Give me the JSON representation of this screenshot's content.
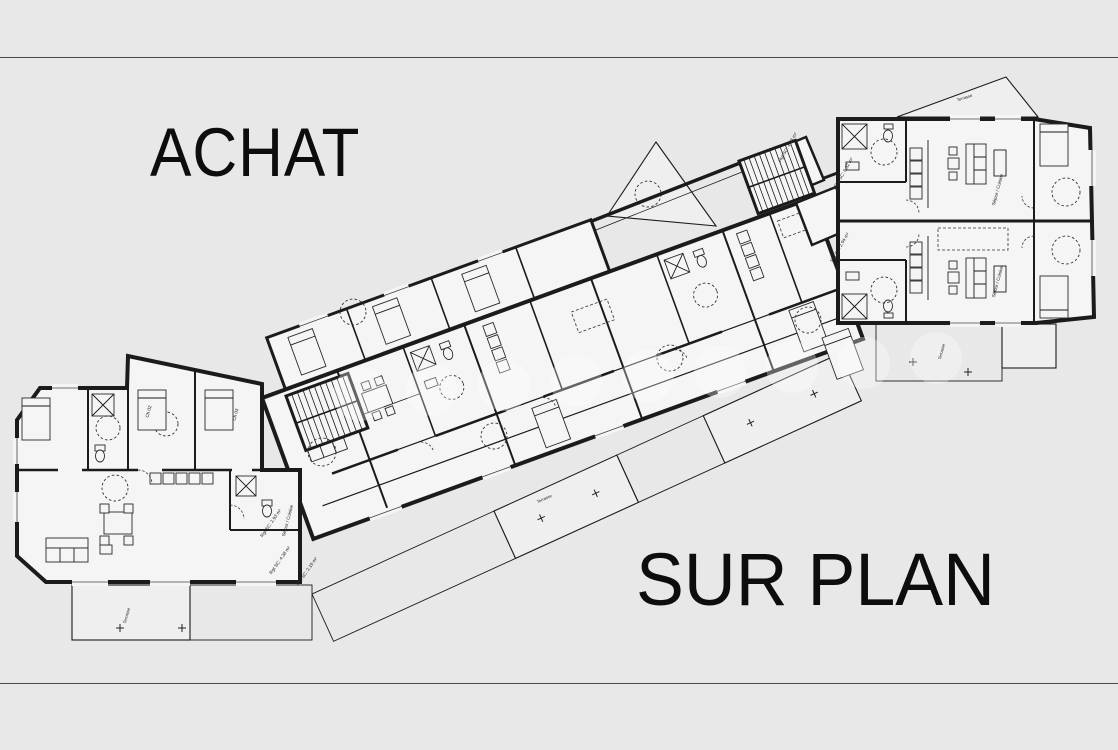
{
  "page": {
    "title_top": "ACHAT",
    "title_bottom": "SUR PLAN"
  },
  "colors": {
    "bg": "#e8e8e8",
    "ink": "#1b1b1b",
    "room": "#f5f5f5",
    "terrace": "#efefef",
    "rule": "#4a4a4a",
    "title": "#0d0d0d",
    "wm": "#ffffff"
  },
  "plan": {
    "type": "architectural floor plan, residential building storey with multiple apartments",
    "annotations": [
      {
        "text": "Rgt SC: 2.93 m²"
      },
      {
        "text": "Rgt SC: 4.38 m²"
      },
      {
        "text": "Rgt SC: 2.19 m²"
      },
      {
        "text": "Rgt SC: 4.93 m²"
      },
      {
        "text": "Rgt SC: 6.52 m²"
      },
      {
        "text": "Rgt SC: 2.94 m²"
      },
      {
        "text": "Ch 02"
      },
      {
        "text": "Ch 03"
      },
      {
        "text": "Séjour / Cuisine"
      },
      {
        "text": "Séjour / Cuisine"
      },
      {
        "text": "Séjour / Cuisine"
      },
      {
        "text": "Terrasse"
      },
      {
        "text": "Terrasse"
      },
      {
        "text": "Terrasse"
      },
      {
        "text": "Terrasse"
      }
    ]
  }
}
